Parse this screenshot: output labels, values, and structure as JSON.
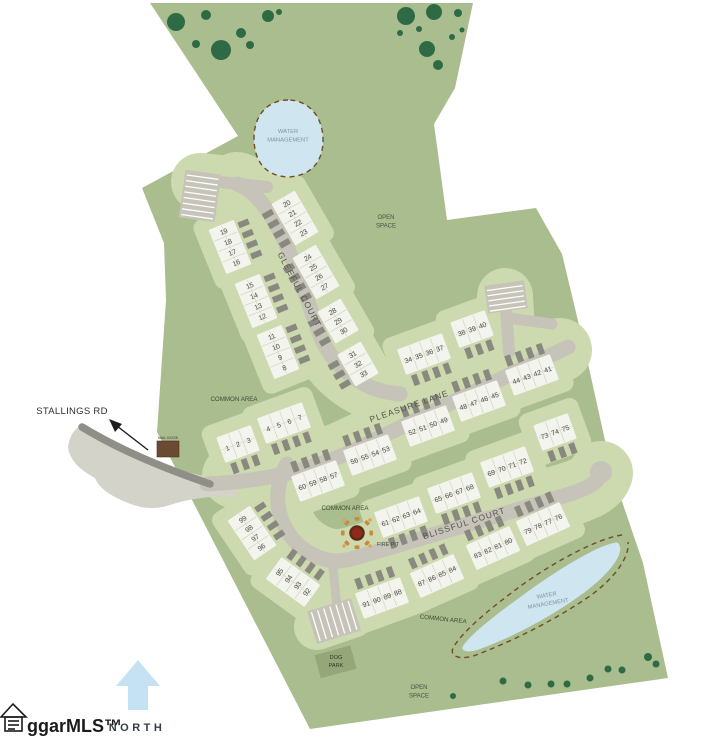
{
  "map_title": "townhome community site plan",
  "north": {
    "label": "NORTH"
  },
  "logo": {
    "text": "ggarMLS™"
  },
  "streets": {
    "gleeful": "GLEEFUL COURT",
    "pleasure": "PLEASURE LANE",
    "blissful": "BLISSFUL COURT",
    "stallings": "STALLINGS RD"
  },
  "colors": {
    "property": "#a9bd8f",
    "pod": "#cdd9ae",
    "road": "#c6c3b8",
    "roadDark": "#8f8f88",
    "driveway": "#89897f",
    "building": "#f4f4ef",
    "unitLine": "#d4d8c6",
    "water": "#cfe6f1",
    "waterEdge": "#6f4d22",
    "tree": "#2e6b45",
    "entrance": "#d4d3c9",
    "stripe": "#ffffff",
    "dogPark": "#95a678",
    "firePitCenter": "#8e2a1e",
    "firePitRing": "#5f2c12",
    "fireSeat": "#c98a40",
    "numText": "#4b4b43",
    "labelDark": "#3f4a36",
    "waterText": "#7d95a3",
    "streetText": "#55554c",
    "northArrow": "#c5e2f4",
    "northText": "#333e49",
    "logoColor": "#1b1b1b",
    "kiosk": "#6b4a33"
  },
  "labels": [
    {
      "id": "stallings-rd-label",
      "lines": [
        "STALLINGS RD"
      ],
      "x": 72,
      "y": 414,
      "size": 9.5,
      "color": "#2e2e2e",
      "ls": 0.3
    },
    {
      "id": "open-space-top",
      "lines": [
        "OPEN",
        "SPACE"
      ],
      "x": 386,
      "y": 219,
      "size": 6,
      "color": "#475240"
    },
    {
      "id": "open-space-bottom",
      "lines": [
        "OPEN",
        "SPACE"
      ],
      "x": 419,
      "y": 689,
      "size": 6,
      "color": "#475240"
    },
    {
      "id": "water-mgmt-top",
      "lines": [
        "WATER",
        "MANAGEMENT"
      ],
      "x": 288,
      "y": 133,
      "size": 5.8,
      "color": "#7d95a3"
    },
    {
      "id": "water-mgmt-bottom",
      "lines": [
        "WATER",
        "MANAGEMENT"
      ],
      "x": 547,
      "y": 597,
      "rot": -10,
      "size": 5.8,
      "color": "#7d95a3"
    },
    {
      "id": "common-area-west",
      "lines": [
        "COMMON AREA"
      ],
      "x": 234,
      "y": 401,
      "size": 6.2,
      "color": "#3f4a36"
    },
    {
      "id": "common-area-firepit",
      "lines": [
        "COMMON AREA"
      ],
      "x": 345,
      "y": 510,
      "size": 6.2,
      "color": "#3f4a36"
    },
    {
      "id": "common-area-southeast",
      "lines": [
        "COMMON AREA"
      ],
      "x": 443,
      "y": 621,
      "rot": 6,
      "size": 6.2,
      "color": "#3f4a36"
    },
    {
      "id": "fire-pit-label",
      "lines": [
        "FIRE PIT"
      ],
      "x": 388,
      "y": 546,
      "size": 5.4,
      "color": "#3f4a36"
    },
    {
      "id": "dog-park-label",
      "lines": [
        "DOG",
        "PARK"
      ],
      "x": 336,
      "y": 659,
      "size": 5.6,
      "color": "#2e3a26"
    },
    {
      "id": "mail-kiosk-label",
      "lines": [
        "MAIL KIOSK"
      ],
      "x": 168,
      "y": 439,
      "size": 3.6,
      "color": "#3a3a32"
    },
    {
      "id": "street-gleeful-court",
      "lines": [
        "GLEEFUL COURT"
      ],
      "x": 297,
      "y": 291,
      "rot": 62,
      "size": 8.5,
      "color": "#55554c",
      "ls": 1
    },
    {
      "id": "street-pleasure-lane",
      "lines": [
        "PLEASURE LANE"
      ],
      "x": 410,
      "y": 409,
      "rot": -19,
      "size": 8.5,
      "color": "#55554c",
      "ls": 1
    },
    {
      "id": "street-blissful-court",
      "lines": [
        "BLISSFUL COURT"
      ],
      "x": 465,
      "y": 526,
      "rot": -18,
      "size": 8.5,
      "color": "#55554c",
      "ls": 1
    }
  ],
  "blocks": [
    {
      "lots": [
        19,
        18,
        17,
        16
      ],
      "cx": 230,
      "cy": 247,
      "rot": 68,
      "side": -1,
      "steep": true
    },
    {
      "lots": [
        15,
        14,
        13,
        12
      ],
      "cx": 256,
      "cy": 301,
      "rot": 68,
      "side": -1,
      "steep": true
    },
    {
      "lots": [
        11,
        10,
        9,
        8
      ],
      "cx": 278,
      "cy": 352,
      "rot": 68,
      "side": -1,
      "steep": true
    },
    {
      "lots": [
        20,
        21,
        22,
        23
      ],
      "cx": 295,
      "cy": 218,
      "rot": 60,
      "side": 1,
      "steep": true
    },
    {
      "lots": [
        24,
        25,
        26,
        27
      ],
      "cx": 316,
      "cy": 272,
      "rot": 60,
      "side": 1,
      "steep": true
    },
    {
      "lots": [
        28,
        29,
        30
      ],
      "cx": 338,
      "cy": 321,
      "rot": 60,
      "side": 1,
      "steep": true
    },
    {
      "lots": [
        31,
        32,
        33
      ],
      "cx": 358,
      "cy": 364,
      "rot": 60,
      "side": 1,
      "steep": true
    },
    {
      "lots": [
        1,
        2,
        3
      ],
      "cx": 238,
      "cy": 444,
      "rot": -20,
      "side": 1,
      "steep": false
    },
    {
      "lots": [
        4,
        5,
        6,
        7
      ],
      "cx": 284,
      "cy": 423,
      "rot": -20,
      "side": 1,
      "steep": false
    },
    {
      "lots": [
        34,
        35,
        36,
        37
      ],
      "cx": 424,
      "cy": 354,
      "rot": -20,
      "side": 1,
      "steep": false
    },
    {
      "lots": [
        38,
        39,
        40
      ],
      "cx": 472,
      "cy": 329,
      "rot": -20,
      "side": 1,
      "steep": false
    },
    {
      "lots": [
        44,
        43,
        42,
        41
      ],
      "cx": 532,
      "cy": 375,
      "rot": -20,
      "side": -1,
      "steep": false
    },
    {
      "lots": [
        48,
        47,
        46,
        45
      ],
      "cx": 479,
      "cy": 401,
      "rot": -20,
      "side": -1,
      "steep": false
    },
    {
      "lots": [
        52,
        51,
        50,
        49
      ],
      "cx": 428,
      "cy": 426,
      "rot": -20,
      "side": -1,
      "steep": false
    },
    {
      "lots": [
        56,
        55,
        54,
        53
      ],
      "cx": 370,
      "cy": 455,
      "rot": -20,
      "side": -1,
      "steep": false
    },
    {
      "lots": [
        60,
        59,
        58,
        57
      ],
      "cx": 318,
      "cy": 481,
      "rot": -20,
      "side": -1,
      "steep": false
    },
    {
      "lots": [
        61,
        62,
        63,
        64
      ],
      "cx": 401,
      "cy": 517,
      "rot": -20,
      "side": 1,
      "steep": false
    },
    {
      "lots": [
        65,
        66,
        67,
        68
      ],
      "cx": 454,
      "cy": 493,
      "rot": -20,
      "side": 1,
      "steep": false
    },
    {
      "lots": [
        69,
        70,
        71,
        72
      ],
      "cx": 507,
      "cy": 467,
      "rot": -20,
      "side": 1,
      "steep": false
    },
    {
      "lots": [
        73,
        74,
        75
      ],
      "cx": 555,
      "cy": 432,
      "rot": -20,
      "side": 1,
      "steep": false
    },
    {
      "lots": [
        79,
        78,
        77,
        76
      ],
      "cx": 543,
      "cy": 524,
      "rot": -24,
      "side": -1,
      "steep": false
    },
    {
      "lots": [
        83,
        82,
        81,
        80
      ],
      "cx": 493,
      "cy": 548,
      "rot": -24,
      "side": -1,
      "steep": false
    },
    {
      "lots": [
        87,
        86,
        85,
        84
      ],
      "cx": 437,
      "cy": 576,
      "rot": -24,
      "side": -1,
      "steep": false
    },
    {
      "lots": [
        91,
        90,
        89,
        88
      ],
      "cx": 382,
      "cy": 598,
      "rot": -20,
      "side": -1,
      "steep": false
    },
    {
      "lots": [
        95,
        94,
        93,
        92
      ],
      "cx": 293,
      "cy": 582,
      "rot": 36,
      "side": -1,
      "steep": true
    },
    {
      "lots": [
        99,
        98,
        97,
        96
      ],
      "cx": 252,
      "cy": 533,
      "rot": 56,
      "side": -1,
      "steep": true
    }
  ],
  "trees": [
    [
      176,
      22,
      9
    ],
    [
      206,
      15,
      5
    ],
    [
      221,
      50,
      10
    ],
    [
      241,
      33,
      5
    ],
    [
      250,
      45,
      4
    ],
    [
      268,
      16,
      6
    ],
    [
      279,
      12,
      3
    ],
    [
      196,
      44,
      4
    ],
    [
      406,
      16,
      9
    ],
    [
      434,
      12,
      8
    ],
    [
      400,
      33,
      3
    ],
    [
      427,
      49,
      8
    ],
    [
      438,
      65,
      5
    ],
    [
      419,
      29,
      3
    ],
    [
      458,
      13,
      4
    ],
    [
      452,
      37,
      3
    ],
    [
      462,
      30,
      2.5
    ]
  ],
  "bushes": [
    [
      503,
      681,
      3.5
    ],
    [
      528,
      685,
      3.5
    ],
    [
      551,
      684,
      3.5
    ],
    [
      567,
      684,
      3.5
    ],
    [
      590,
      678,
      3.5
    ],
    [
      608,
      669,
      3.5
    ],
    [
      622,
      670,
      3.5
    ],
    [
      648,
      657,
      4
    ],
    [
      656,
      664,
      3.5
    ],
    [
      453,
      696,
      3
    ]
  ]
}
